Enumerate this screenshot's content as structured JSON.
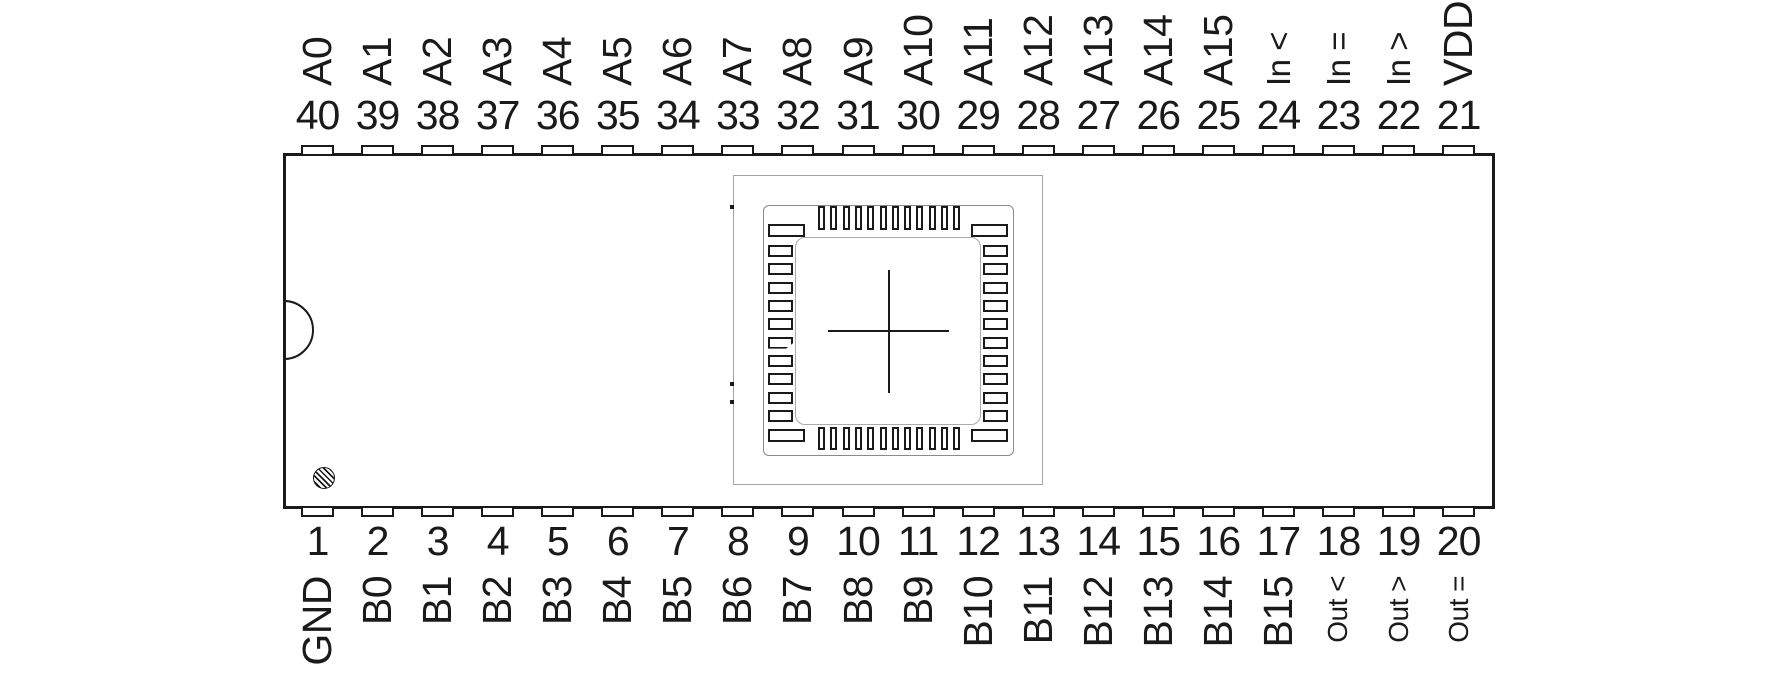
{
  "diagram": {
    "type": "ic-pinout",
    "package": "DIP-40",
    "center_footprint": "qfn-socket-footprint",
    "markers": {
      "index_notch": "left-edge-semicircle",
      "pin1_marker": "hatched-circle",
      "die_alignment": "crosshair"
    },
    "colors": {
      "line": "#1a1a1a",
      "footprint_outline": "#a3a3a3",
      "background": "#ffffff"
    }
  },
  "pins": {
    "top": [
      {
        "number": "40",
        "label": "A0"
      },
      {
        "number": "39",
        "label": "A1"
      },
      {
        "number": "38",
        "label": "A2"
      },
      {
        "number": "37",
        "label": "A3"
      },
      {
        "number": "36",
        "label": "A4"
      },
      {
        "number": "35",
        "label": "A5"
      },
      {
        "number": "34",
        "label": "A6"
      },
      {
        "number": "33",
        "label": "A7"
      },
      {
        "number": "32",
        "label": "A8"
      },
      {
        "number": "31",
        "label": "A9"
      },
      {
        "number": "30",
        "label": "A10"
      },
      {
        "number": "29",
        "label": "A11"
      },
      {
        "number": "28",
        "label": "A12"
      },
      {
        "number": "27",
        "label": "A13"
      },
      {
        "number": "26",
        "label": "A14"
      },
      {
        "number": "25",
        "label": "A15"
      },
      {
        "number": "24",
        "label": "In <"
      },
      {
        "number": "23",
        "label": "In ="
      },
      {
        "number": "22",
        "label": "In >"
      },
      {
        "number": "21",
        "label": "VDD"
      }
    ],
    "bottom": [
      {
        "number": "1",
        "label": "GND"
      },
      {
        "number": "2",
        "label": "B0"
      },
      {
        "number": "3",
        "label": "B1"
      },
      {
        "number": "4",
        "label": "B2"
      },
      {
        "number": "5",
        "label": "B3"
      },
      {
        "number": "6",
        "label": "B4"
      },
      {
        "number": "7",
        "label": "B5"
      },
      {
        "number": "8",
        "label": "B6"
      },
      {
        "number": "9",
        "label": "B7"
      },
      {
        "number": "10",
        "label": "B8"
      },
      {
        "number": "11",
        "label": "B9"
      },
      {
        "number": "12",
        "label": "B10"
      },
      {
        "number": "13",
        "label": "B11"
      },
      {
        "number": "14",
        "label": "B12"
      },
      {
        "number": "15",
        "label": "B13"
      },
      {
        "number": "16",
        "label": "B14"
      },
      {
        "number": "17",
        "label": "B15"
      },
      {
        "number": "18",
        "label": "Out <"
      },
      {
        "number": "19",
        "label": "Out >"
      },
      {
        "number": "20",
        "label": "Out ="
      }
    ]
  }
}
